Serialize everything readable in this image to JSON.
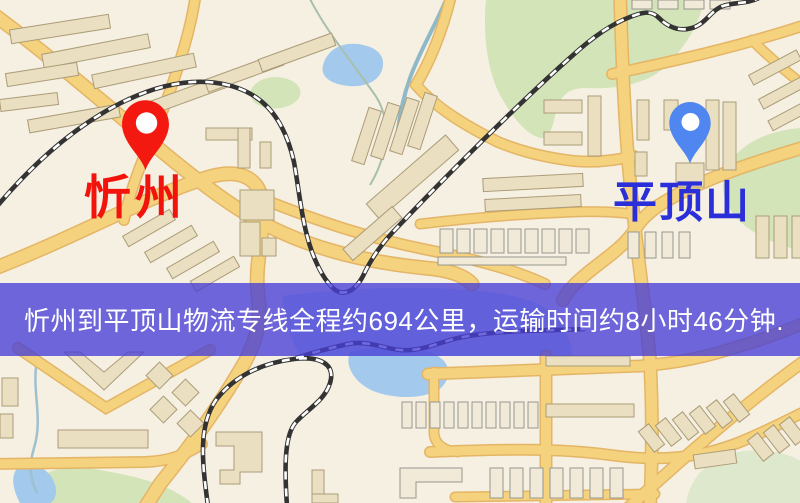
{
  "banner": {
    "text": "忻州到平顶山物流专线全程约694公里，运输时间约8小时46分钟.",
    "background_rgba": "rgba(70,62,214,0.78)",
    "text_color": "#ffffff"
  },
  "origin": {
    "label": "忻州",
    "pin_color": "#f31911",
    "label_color": "#f2140c"
  },
  "destination": {
    "label": "平顶山",
    "pin_color": "#4f86f0",
    "label_color": "#2b2fd9"
  },
  "route": {
    "distance_text": "约694公里",
    "duration_text": "约8小时46分钟"
  },
  "map_colors": {
    "background": "#f5f0e2",
    "road_fill": "#f5d27e",
    "road_casing": "#e4b566",
    "building_fill": "#eadfc0",
    "building_stroke": "#ac9c78",
    "building_light_fill": "#f1ead9",
    "building_light_stroke": "#97968e",
    "park": "#d2e4b8",
    "park_muted": "#dde8cc",
    "water": "#a3c9ec",
    "water_light": "#c6dcef",
    "railway": "#333333",
    "stream": "#9fc0cf"
  }
}
